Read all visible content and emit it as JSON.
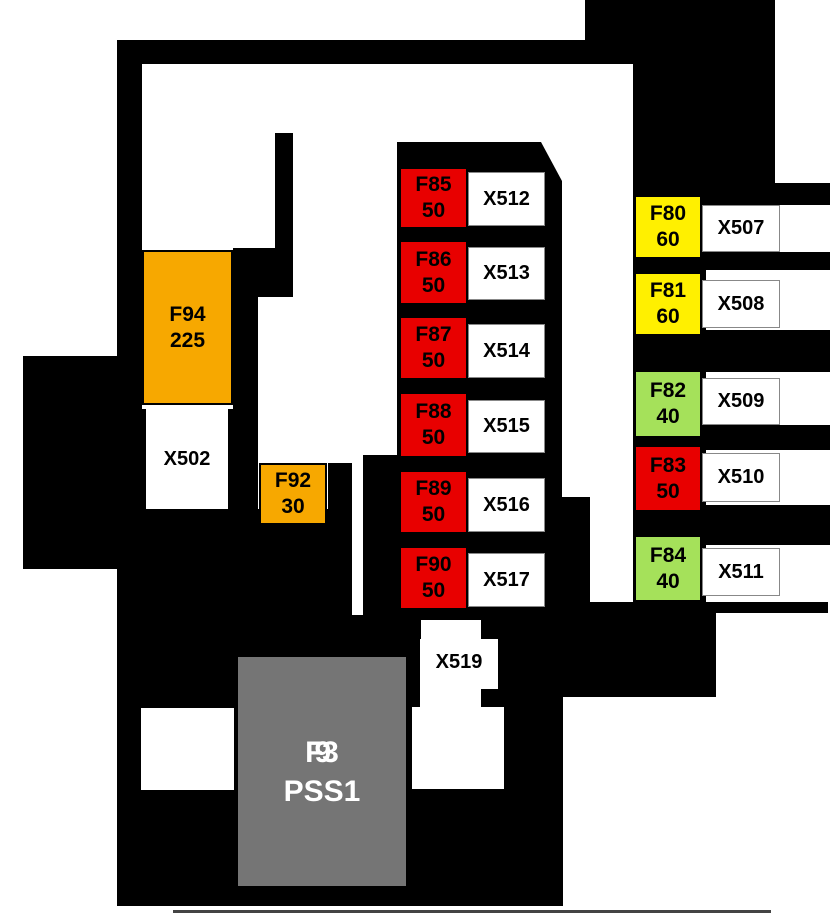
{
  "colors": {
    "black": "#000000",
    "white": "#ffffff",
    "orange": "#F7A800",
    "red": "#E80000",
    "yellow": "#FFF000",
    "green": "#A5E15A",
    "gray": "#757575",
    "line": "#444444"
  },
  "fuses": {
    "F94": {
      "id": "F94",
      "rating": "225",
      "color": "#F7A800"
    },
    "F92": {
      "id": "F92",
      "rating": "30",
      "color": "#F7A800"
    },
    "F85": {
      "id": "F85",
      "rating": "50",
      "color": "#E80000"
    },
    "F86": {
      "id": "F86",
      "rating": "50",
      "color": "#E80000"
    },
    "F87": {
      "id": "F87",
      "rating": "50",
      "color": "#E80000"
    },
    "F88": {
      "id": "F88",
      "rating": "50",
      "color": "#E80000"
    },
    "F89": {
      "id": "F89",
      "rating": "50",
      "color": "#E80000"
    },
    "F90": {
      "id": "F90",
      "rating": "50",
      "color": "#E80000"
    },
    "F80": {
      "id": "F80",
      "rating": "60",
      "color": "#FFF000"
    },
    "F81": {
      "id": "F81",
      "rating": "60",
      "color": "#FFF000"
    },
    "F82": {
      "id": "F82",
      "rating": "40",
      "color": "#A5E15A"
    },
    "F83": {
      "id": "F83",
      "rating": "50",
      "color": "#E80000"
    },
    "F84": {
      "id": "F84",
      "rating": "40",
      "color": "#A5E15A"
    },
    "F93": {
      "id": "F93",
      "rating": "PSS1",
      "color": "#757575"
    }
  },
  "connectors": {
    "X502": "X502",
    "X512": "X512",
    "X513": "X513",
    "X514": "X514",
    "X515": "X515",
    "X516": "X516",
    "X517": "X517",
    "X507": "X507",
    "X508": "X508",
    "X509": "X509",
    "X510": "X510",
    "X511": "X511",
    "X519": "X519"
  }
}
